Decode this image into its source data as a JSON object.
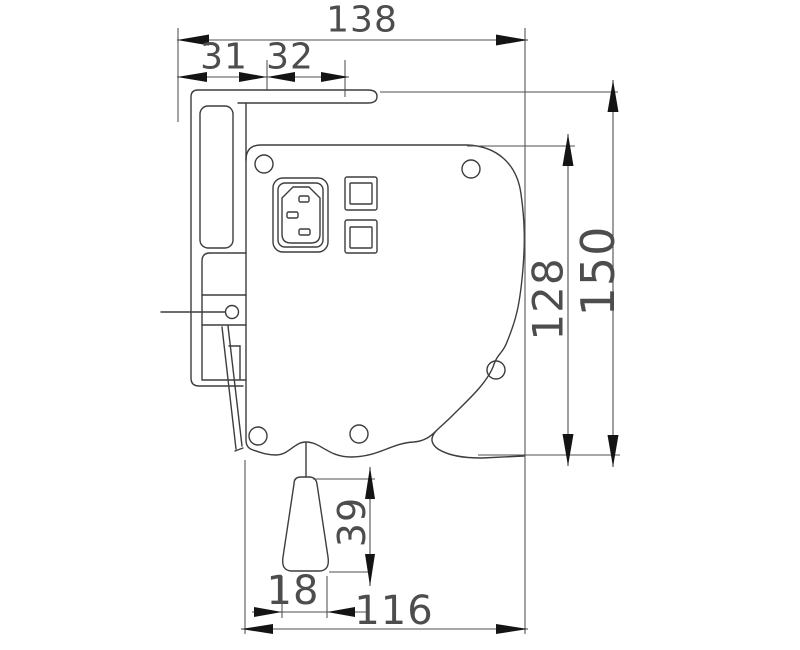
{
  "drawing": {
    "colors": {
      "background": "#ffffff",
      "part_line": "#3d3d3d",
      "dimension_line": "#4f4f4f",
      "arrowhead": "#141414",
      "dimension_text": "#4d4d4d"
    },
    "dims": {
      "total_width": "138",
      "flange_left": "31",
      "flange_right": "32",
      "overall_height": "150",
      "body_height": "128",
      "handle_drop": "39",
      "handle_width": "18",
      "body_width": "116"
    }
  }
}
